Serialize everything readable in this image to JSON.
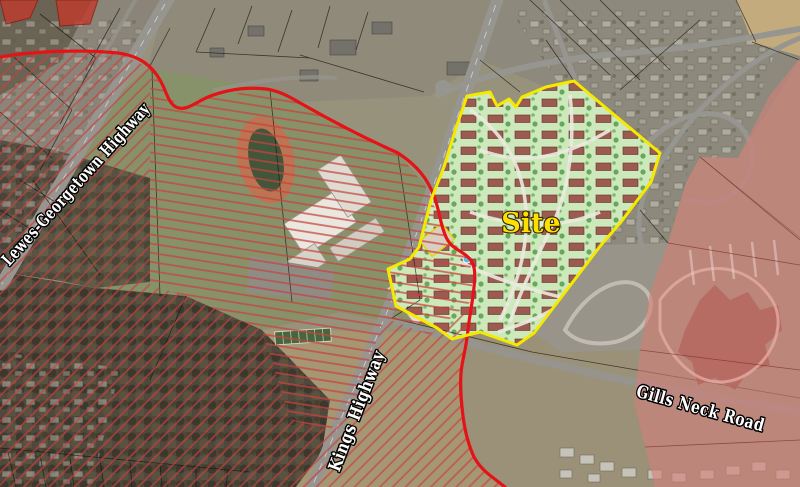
{
  "map": {
    "site_label": "Site",
    "road_labels": {
      "lewes_georgetown_highway": "Lewes-Georgetown Highway",
      "kings_highway": "Kings Highway",
      "gills_neck_road": "Gills Neck Road"
    },
    "colors": {
      "site_boundary_yellow": "#f6e900",
      "site_label_yellow": "#ffdf00",
      "boundary_line_red": "#e51317",
      "hatch_red": "#c8423c",
      "overlay_pink": "#d47f79",
      "solid_red_parcel": "#c23a2d",
      "road_label_fill": "#ffffff",
      "road_label_outline": "#000000"
    }
  }
}
